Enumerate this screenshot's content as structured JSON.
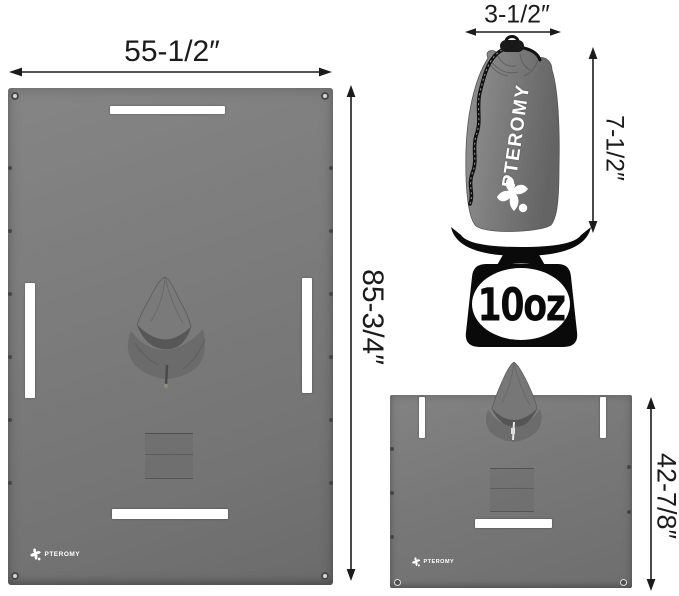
{
  "brand": {
    "name": "PTEROMY"
  },
  "weight": {
    "value": "10oz"
  },
  "annotations": {
    "tarp_width": "55-1/2″",
    "tarp_height": "85-3/4″",
    "bag_width": "3-1/2″",
    "bag_height": "7-1/2″",
    "poncho_height": "42-7/8″"
  },
  "colors": {
    "fabric_gray": "#7a7a7a",
    "fabric_shadow": "#636363",
    "hood_opening": "#565656",
    "reflective_white": "#ffffff",
    "scale_black": "#0a0a0a",
    "dimension_ink": "#1b1b1b",
    "background": "#ffffff"
  },
  "icons": {
    "scale": "kitchen-scale-silhouette",
    "brand_mark": "flying-squirrel-star",
    "arrows": "double-headed-dimension-arrow"
  }
}
